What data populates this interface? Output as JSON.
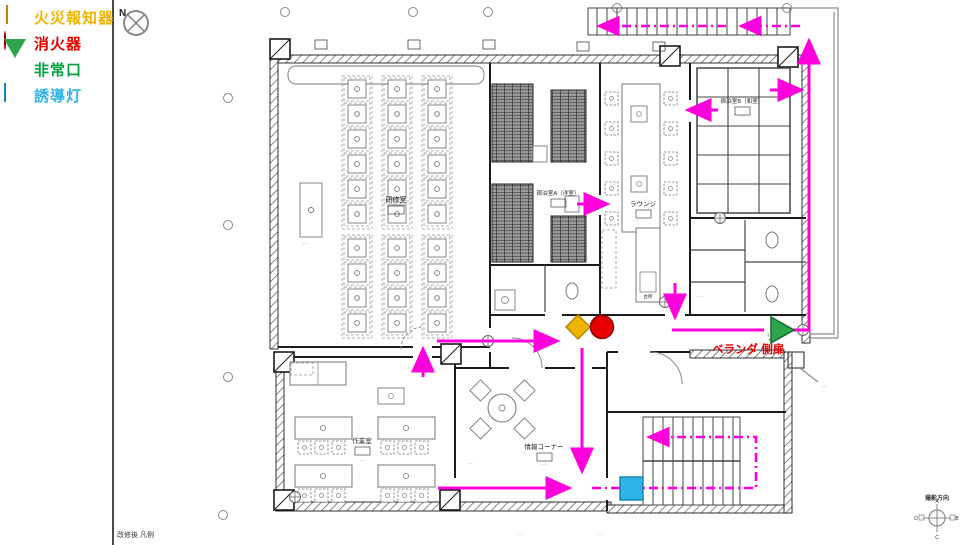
{
  "title": "避難経路図 (evacuation route floor plan)",
  "colors": {
    "route": "#ff00dc",
    "alarm": "#f0b400",
    "alarm2": "#b88600",
    "ext": "#e60000",
    "ext2": "#8b0000",
    "exitc": "#2ea44e",
    "exitc2": "#146c2e",
    "guide": "#2fb4e8",
    "guide2": "#1587b5",
    "redtext": "#e60000"
  },
  "legend": {
    "items": [
      {
        "label": "火災報知器",
        "symbol": "diamond",
        "color": "#f0b400"
      },
      {
        "label": "消火器",
        "symbol": "circle",
        "color": "#e60000"
      },
      {
        "label": "非常口",
        "symbol": "triangle-down",
        "color": "#2ea44e"
      },
      {
        "label": "誘導灯",
        "symbol": "square",
        "color": "#2fb4e8"
      }
    ]
  },
  "compass": {
    "label": "N"
  },
  "rooms": [
    {
      "name": "研修室"
    },
    {
      "name": "宿泊室A（洋室）"
    },
    {
      "name": "ラウンジ"
    },
    {
      "name": "宿泊室B（和室）"
    },
    {
      "name": "台所"
    },
    {
      "name": "作業室"
    },
    {
      "name": "情報コーナー"
    }
  ],
  "annotations": {
    "veranda_door": "ベランダ 側扉",
    "bottom_left_note": "改修後 凡例",
    "direction_marker": {
      "label": "撮影方向",
      "points": {
        "a": "A",
        "b": "B",
        "c": "C",
        "d": "D"
      }
    }
  },
  "markers": [
    {
      "id": "fire-alarm",
      "symbol": "diamond",
      "location": "entrance-hall"
    },
    {
      "id": "fire-extinguisher",
      "symbol": "circle",
      "location": "entrance-hall"
    },
    {
      "id": "emergency-exit",
      "symbol": "triangle-right",
      "location": "veranda-side-door"
    },
    {
      "id": "guide-light",
      "symbol": "square",
      "location": "stair-hall"
    }
  ],
  "routes": {
    "color": "#ff00dc",
    "solid_segments": "corridor→east, workroom→up, bedroomA→lounge, tatami→lounge, tatami→veranda, lounge→down→exit, veranda→up→outside-stair, hall→down→stairs, workroom→stairs",
    "dashed_segments": "outside-stair→left, inner-stair loop"
  },
  "micro": "·····"
}
